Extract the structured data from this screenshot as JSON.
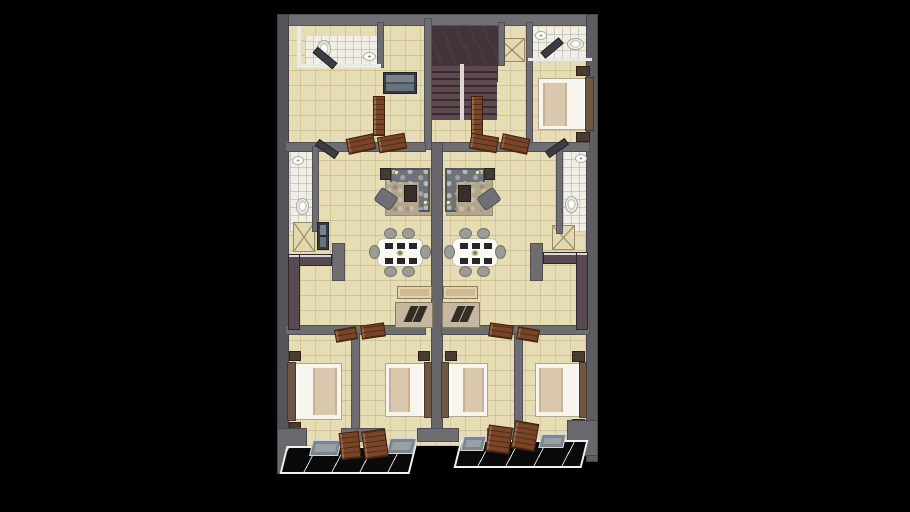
{
  "scene": {
    "description": "3D rendered duplex apartment floor plan, two mirrored units, viewed from above on black background",
    "background": "#000000",
    "plan": {
      "left": 277,
      "top": 14,
      "width": 321,
      "height": 466
    }
  },
  "palette": {
    "wall_gray": "#6e6e71",
    "wall_dark": "#56565c",
    "wall_white": "#e9e9e5",
    "floor_beige": "#e7ddb4",
    "bath_tile": "#f1eee6",
    "stair_dark": "#43333a",
    "door_wood": "#7a4526",
    "counter_dark": "#574a50",
    "porch_black": "#0a0a0a",
    "rug_taupe": "#b4a58d",
    "sofa_gray": "#6e7277",
    "bed_white": "#f7f5ee",
    "blanket_tan": "#d9c7ae",
    "console_wood": "#cfba93"
  },
  "elements": [
    {
      "n": "interior-floor",
      "t": "floor",
      "x": 8,
      "y": 8,
      "w": 305,
      "h": 424
    },
    {
      "n": "bathroom-top-left-floor",
      "t": "floor-bath",
      "x": 28,
      "y": 22,
      "w": 74,
      "h": 30
    },
    {
      "n": "bathroom-top-right-floor",
      "t": "floor-bath",
      "x": 253,
      "y": 13,
      "w": 62,
      "h": 32
    },
    {
      "n": "bathroom-mid-left-floor",
      "t": "floor-bath",
      "x": 13,
      "y": 138,
      "w": 22,
      "h": 80
    },
    {
      "n": "bathroom-mid-right-floor",
      "t": "floor-bath",
      "x": 286,
      "y": 136,
      "w": 24,
      "h": 82
    },
    {
      "n": "stair-ceiling-slab",
      "t": "stair-slab",
      "x": 151,
      "y": 12,
      "w": 70,
      "h": 40
    },
    {
      "n": "stair-ceiling-slab-lower",
      "t": "stair-slab",
      "x": 187,
      "y": 30,
      "w": 34,
      "h": 38
    },
    {
      "n": "stair-treads",
      "t": "stair-treads",
      "x": 153,
      "y": 52,
      "w": 67,
      "h": 54
    },
    {
      "n": "stair-stringer",
      "t": "stair-stringer",
      "x": 183,
      "y": 50,
      "w": 4,
      "h": 58
    },
    {
      "n": "shaft-x-top",
      "t": "closet-x",
      "x": 222,
      "y": 24,
      "w": 26,
      "h": 24
    },
    {
      "n": "shaft-x-mid-left",
      "t": "closet-x",
      "x": 16,
      "y": 208,
      "w": 22,
      "h": 30
    },
    {
      "n": "shaft-x-mid-right",
      "t": "closet-x",
      "x": 275,
      "y": 211,
      "w": 23,
      "h": 25
    },
    {
      "n": "rug-left-unit",
      "t": "rug",
      "x": 108,
      "y": 154,
      "w": 47,
      "h": 48
    },
    {
      "n": "rug-right-unit",
      "t": "rug",
      "x": 169,
      "y": 154,
      "w": 47,
      "h": 48
    },
    {
      "n": "wall-top",
      "t": "wall",
      "x": 0,
      "y": 0,
      "w": 321,
      "h": 12,
      "f": "#707074"
    },
    {
      "n": "wall-left",
      "t": "wall",
      "x": 0,
      "y": 0,
      "w": 12,
      "h": 452,
      "f": "#55555b"
    },
    {
      "n": "wall-right",
      "t": "wall",
      "x": 309,
      "y": 0,
      "w": 12,
      "h": 448,
      "f": "#5d5d62"
    },
    {
      "n": "wall-stair-left",
      "t": "wall",
      "x": 147,
      "y": 4,
      "w": 8,
      "h": 132
    },
    {
      "n": "wall-stair-right",
      "t": "wall",
      "x": 221,
      "y": 8,
      "w": 7,
      "h": 44
    },
    {
      "n": "wall-bath-top-left-east",
      "t": "wall",
      "x": 100,
      "y": 8,
      "w": 7,
      "h": 46
    },
    {
      "n": "wall-bedroom-top-right-west",
      "t": "wall",
      "x": 249,
      "y": 8,
      "w": 7,
      "h": 122
    },
    {
      "n": "wall-mid-horizontal-left",
      "t": "wall",
      "x": 8,
      "y": 128,
      "w": 141,
      "h": 10
    },
    {
      "n": "wall-mid-horizontal-right",
      "t": "wall",
      "x": 164,
      "y": 128,
      "w": 149,
      "h": 10
    },
    {
      "n": "wall-center-party",
      "t": "wall",
      "x": 154,
      "y": 128,
      "w": 12,
      "h": 294,
      "f": "#67676b"
    },
    {
      "n": "wall-bath-mid-left-east",
      "t": "wall",
      "x": 35,
      "y": 132,
      "w": 7,
      "h": 86
    },
    {
      "n": "wall-bath-mid-right-west",
      "t": "wall",
      "x": 279,
      "y": 130,
      "w": 7,
      "h": 90
    },
    {
      "n": "wall-kitchen-stub-left",
      "t": "wall",
      "x": 55,
      "y": 229,
      "w": 13,
      "h": 38
    },
    {
      "n": "wall-kitchen-stub-right",
      "t": "wall",
      "x": 253,
      "y": 229,
      "w": 13,
      "h": 38
    },
    {
      "n": "wall-bedroom-band-left",
      "t": "wall",
      "x": 8,
      "y": 311,
      "w": 141,
      "h": 10
    },
    {
      "n": "wall-bedroom-band-right",
      "t": "wall",
      "x": 164,
      "y": 311,
      "w": 149,
      "h": 10
    },
    {
      "n": "wall-bedroom-sep-ab",
      "t": "wall",
      "x": 74,
      "y": 319,
      "w": 9,
      "h": 103
    },
    {
      "n": "wall-bedroom-sep-cd",
      "t": "wall",
      "x": 237,
      "y": 319,
      "w": 9,
      "h": 103
    },
    {
      "n": "wall-bottom-seg-1",
      "t": "wall",
      "x": 8,
      "y": 414,
      "w": 22,
      "h": 14
    },
    {
      "n": "wall-bottom-seg-2",
      "t": "wall",
      "x": 64,
      "y": 414,
      "w": 44,
      "h": 14
    },
    {
      "n": "wall-bottom-seg-3",
      "t": "wall",
      "x": 140,
      "y": 414,
      "w": 42,
      "h": 14
    },
    {
      "n": "wall-bottom-seg-4",
      "t": "wall",
      "x": 210,
      "y": 414,
      "w": 48,
      "h": 14
    },
    {
      "n": "wall-bottom-seg-5",
      "t": "wall",
      "x": 290,
      "y": 414,
      "w": 23,
      "h": 14
    },
    {
      "n": "wall-cap-white-top-left",
      "t": "wall-white",
      "x": 20,
      "y": 12,
      "w": 4,
      "h": 42
    },
    {
      "n": "wall-cap-white-bath-tl",
      "t": "wall-white",
      "x": 24,
      "y": 50,
      "w": 80,
      "h": 4
    },
    {
      "n": "wall-cap-white-bath-tr",
      "t": "wall-white",
      "x": 251,
      "y": 44,
      "w": 64,
      "h": 3
    },
    {
      "n": "kitchen-counter-left-top",
      "t": "counter",
      "x": 11,
      "y": 240,
      "w": 44,
      "h": 12
    },
    {
      "n": "kitchen-counter-left-side",
      "t": "counter",
      "x": 11,
      "y": 240,
      "w": 12,
      "h": 76
    },
    {
      "n": "kitchen-counter-right-top",
      "t": "counter",
      "x": 266,
      "y": 238,
      "w": 45,
      "h": 12
    },
    {
      "n": "kitchen-counter-right-side",
      "t": "counter",
      "x": 299,
      "y": 238,
      "w": 12,
      "h": 78
    },
    {
      "n": "fridge-cabinet-left",
      "t": "cabinet",
      "x": 40,
      "y": 208,
      "w": 12,
      "h": 28
    },
    {
      "n": "hall-cabinet-stair",
      "t": "cabinet",
      "x": 106,
      "y": 58,
      "w": 34,
      "h": 22
    },
    {
      "n": "sofa-sectional-left",
      "t": "sofa-l",
      "x": 113,
      "y": 154,
      "w": 40,
      "h": 44,
      "c": "polygon(0% 0%,100% 0%,100% 100%,72% 100%,72% 32%,0% 32%)"
    },
    {
      "n": "sofa-sectional-right",
      "t": "sofa-l",
      "x": 168,
      "y": 154,
      "w": 40,
      "h": 44,
      "c": "polygon(0% 0%,100% 0%,100% 32%,28% 32%,28% 100%,0% 100%)"
    },
    {
      "n": "side-table-left",
      "t": "side-table",
      "x": 103,
      "y": 154,
      "w": 11,
      "h": 12
    },
    {
      "n": "side-table-right",
      "t": "side-table",
      "x": 207,
      "y": 154,
      "w": 11,
      "h": 12
    },
    {
      "n": "coffee-table-left",
      "t": "coffee-table",
      "x": 127,
      "y": 171,
      "w": 13,
      "h": 17
    },
    {
      "n": "coffee-table-right",
      "t": "coffee-table",
      "x": 181,
      "y": 171,
      "w": 13,
      "h": 17
    },
    {
      "n": "armchair-left",
      "t": "armchair",
      "x": 99,
      "y": 177,
      "w": 20,
      "h": 16,
      "r": 35
    },
    {
      "n": "armchair-right",
      "t": "armchair",
      "x": 202,
      "y": 177,
      "w": 20,
      "h": 16,
      "r": -35
    },
    {
      "n": "plant-left-1",
      "t": "plant",
      "x": 117,
      "y": 156,
      "w": 6,
      "h": 6
    },
    {
      "n": "plant-left-2",
      "t": "plant",
      "x": 146,
      "y": 186,
      "w": 6,
      "h": 6
    },
    {
      "n": "plant-right-1",
      "t": "plant",
      "x": 198,
      "y": 156,
      "w": 6,
      "h": 6
    },
    {
      "n": "plant-right-2",
      "t": "plant",
      "x": 169,
      "y": 186,
      "w": 6,
      "h": 6
    },
    {
      "n": "dining-table-left",
      "t": "dining-table",
      "x": 100,
      "y": 224,
      "w": 46,
      "h": 29
    },
    {
      "n": "dining-chair",
      "t": "chair",
      "x": 107,
      "y": 214,
      "w": 13,
      "h": 11
    },
    {
      "n": "dining-chair",
      "t": "chair",
      "x": 125,
      "y": 214,
      "w": 13,
      "h": 11
    },
    {
      "n": "dining-chair",
      "t": "chair",
      "x": 107,
      "y": 252,
      "w": 13,
      "h": 11
    },
    {
      "n": "dining-chair",
      "t": "chair",
      "x": 125,
      "y": 252,
      "w": 13,
      "h": 11
    },
    {
      "n": "dining-chair",
      "t": "chair",
      "x": 92,
      "y": 231,
      "w": 11,
      "h": 14
    },
    {
      "n": "dining-chair",
      "t": "chair",
      "x": 143,
      "y": 231,
      "w": 11,
      "h": 14
    },
    {
      "n": "dining-table-right",
      "t": "dining-table",
      "x": 175,
      "y": 224,
      "w": 46,
      "h": 29
    },
    {
      "n": "dining-chair",
      "t": "chair",
      "x": 182,
      "y": 214,
      "w": 13,
      "h": 11
    },
    {
      "n": "dining-chair",
      "t": "chair",
      "x": 200,
      "y": 214,
      "w": 13,
      "h": 11
    },
    {
      "n": "dining-chair",
      "t": "chair",
      "x": 182,
      "y": 252,
      "w": 13,
      "h": 11
    },
    {
      "n": "dining-chair",
      "t": "chair",
      "x": 200,
      "y": 252,
      "w": 13,
      "h": 11
    },
    {
      "n": "dining-chair",
      "t": "chair",
      "x": 167,
      "y": 231,
      "w": 11,
      "h": 14
    },
    {
      "n": "dining-chair",
      "t": "chair",
      "x": 218,
      "y": 231,
      "w": 11,
      "h": 14
    },
    {
      "n": "tv-console-left",
      "t": "console",
      "x": 120,
      "y": 272,
      "w": 35,
      "h": 13
    },
    {
      "n": "tv-console-right",
      "t": "console",
      "x": 166,
      "y": 272,
      "w": 35,
      "h": 13
    },
    {
      "n": "sofa-low-left",
      "t": "sofa-low",
      "x": 118,
      "y": 288,
      "w": 38,
      "h": 26
    },
    {
      "n": "sofa-low-right",
      "t": "sofa-low",
      "x": 165,
      "y": 288,
      "w": 38,
      "h": 26
    },
    {
      "n": "bed-top-right",
      "t": "bed",
      "v": "head-right",
      "x": 261,
      "y": 64,
      "w": 54,
      "h": 52
    },
    {
      "n": "nightstand",
      "t": "nightstand",
      "x": 299,
      "y": 52,
      "w": 14,
      "h": 10
    },
    {
      "n": "nightstand",
      "t": "nightstand",
      "x": 299,
      "y": 118,
      "w": 14,
      "h": 10
    },
    {
      "n": "bed-bottom-a",
      "t": "bed",
      "v": "head-left",
      "x": 12,
      "y": 349,
      "w": 53,
      "h": 57
    },
    {
      "n": "nightstand",
      "t": "nightstand",
      "x": 12,
      "y": 337,
      "w": 12,
      "h": 10
    },
    {
      "n": "nightstand",
      "t": "nightstand",
      "x": 12,
      "y": 408,
      "w": 12,
      "h": 10
    },
    {
      "n": "bed-bottom-b",
      "t": "bed",
      "v": "head-right",
      "x": 108,
      "y": 349,
      "w": 45,
      "h": 54
    },
    {
      "n": "nightstand",
      "t": "nightstand",
      "x": 141,
      "y": 337,
      "w": 12,
      "h": 10
    },
    {
      "n": "bed-bottom-c",
      "t": "bed",
      "v": "head-left",
      "x": 166,
      "y": 349,
      "w": 45,
      "h": 54
    },
    {
      "n": "nightstand",
      "t": "nightstand",
      "x": 168,
      "y": 337,
      "w": 12,
      "h": 10
    },
    {
      "n": "bed-bottom-d",
      "t": "bed",
      "v": "head-right",
      "x": 258,
      "y": 349,
      "w": 50,
      "h": 54
    },
    {
      "n": "nightstand",
      "t": "nightstand",
      "x": 295,
      "y": 337,
      "w": 13,
      "h": 11
    },
    {
      "n": "nightstand",
      "t": "nightstand",
      "x": 295,
      "y": 405,
      "w": 13,
      "h": 11
    },
    {
      "n": "toilet",
      "t": "toilet",
      "x": 40,
      "y": 26,
      "w": 14,
      "h": 18
    },
    {
      "n": "sink",
      "t": "sink",
      "x": 86,
      "y": 38,
      "w": 13,
      "h": 9
    },
    {
      "n": "toilet",
      "t": "toilet",
      "x": 290,
      "y": 24,
      "w": 17,
      "h": 12
    },
    {
      "n": "sink",
      "t": "sink",
      "x": 258,
      "y": 17,
      "w": 12,
      "h": 9
    },
    {
      "n": "toilet",
      "t": "toilet",
      "x": 19,
      "y": 184,
      "w": 13,
      "h": 17
    },
    {
      "n": "sink",
      "t": "sink",
      "x": 15,
      "y": 142,
      "w": 12,
      "h": 9
    },
    {
      "n": "toilet",
      "t": "toilet",
      "x": 288,
      "y": 182,
      "w": 13,
      "h": 17
    },
    {
      "n": "sink",
      "t": "sink",
      "x": 298,
      "y": 140,
      "w": 12,
      "h": 9
    },
    {
      "n": "door-leaf-bath-tl",
      "t": "door-dark",
      "x": 35,
      "y": 40,
      "w": 26,
      "h": 8,
      "r": 40
    },
    {
      "n": "door-leaf-bath-tr",
      "t": "door-dark",
      "x": 263,
      "y": 30,
      "w": 24,
      "h": 8,
      "r": -40
    },
    {
      "n": "door-leaf-bath-ml",
      "t": "door-dark",
      "x": 38,
      "y": 131,
      "w": 24,
      "h": 8,
      "r": 35
    },
    {
      "n": "door-leaf-bath-mr",
      "t": "door-dark",
      "x": 268,
      "y": 130,
      "w": 24,
      "h": 8,
      "r": -35
    },
    {
      "n": "door-leaf-bedroom-top-left",
      "t": "door-wood",
      "x": 96,
      "y": 82,
      "w": 12,
      "h": 40
    },
    {
      "n": "door-leaf-bedroom-top-right",
      "t": "door-wood",
      "x": 194,
      "y": 82,
      "w": 12,
      "h": 40
    },
    {
      "n": "door-leaf-hall-1",
      "t": "door-wood",
      "x": 70,
      "y": 122,
      "w": 28,
      "h": 16,
      "r": -12
    },
    {
      "n": "door-leaf-hall-2",
      "t": "door-wood",
      "x": 101,
      "y": 121,
      "w": 28,
      "h": 16,
      "r": -10
    },
    {
      "n": "door-leaf-hall-3",
      "t": "door-wood",
      "x": 193,
      "y": 121,
      "w": 28,
      "h": 16,
      "r": 10
    },
    {
      "n": "door-leaf-hall-4",
      "t": "door-wood",
      "x": 224,
      "y": 122,
      "w": 28,
      "h": 16,
      "r": 12
    },
    {
      "n": "door-leaf-bedroom-a",
      "t": "door-wood",
      "x": 58,
      "y": 314,
      "w": 22,
      "h": 13,
      "r": -10
    },
    {
      "n": "door-leaf-bedroom-b",
      "t": "door-wood",
      "x": 84,
      "y": 310,
      "w": 24,
      "h": 14,
      "r": -8
    },
    {
      "n": "door-leaf-bedroom-c",
      "t": "door-wood",
      "x": 212,
      "y": 310,
      "w": 24,
      "h": 14,
      "r": 8
    },
    {
      "n": "door-leaf-bedroom-d",
      "t": "door-wood",
      "x": 240,
      "y": 314,
      "w": 22,
      "h": 13,
      "r": 10
    },
    {
      "n": "terrace-slab-left",
      "t": "slab",
      "x": 0,
      "y": 414,
      "w": 30,
      "h": 46
    },
    {
      "n": "terrace-slab-right",
      "t": "slab",
      "x": 290,
      "y": 406,
      "w": 31,
      "h": 36
    },
    {
      "n": "entry-porch-left",
      "t": "porch",
      "x": 6,
      "y": 432,
      "w": 130,
      "h": 28
    },
    {
      "n": "entry-porch-right",
      "t": "porch",
      "x": 180,
      "y": 426,
      "w": 128,
      "h": 28
    },
    {
      "n": "entry-mat",
      "t": "mat",
      "x": 34,
      "y": 426,
      "w": 29,
      "h": 16
    },
    {
      "n": "entry-mat",
      "t": "mat",
      "x": 111,
      "y": 424,
      "w": 27,
      "h": 16
    },
    {
      "n": "entry-mat",
      "t": "mat",
      "x": 185,
      "y": 422,
      "w": 23,
      "h": 15
    },
    {
      "n": "entry-mat",
      "t": "mat",
      "x": 263,
      "y": 420,
      "w": 25,
      "h": 14
    },
    {
      "n": "entry-door-left-1",
      "t": "door-wood",
      "x": 63,
      "y": 418,
      "w": 20,
      "h": 27,
      "r": -6
    },
    {
      "n": "entry-door-left-2",
      "t": "door-wood",
      "x": 86,
      "y": 416,
      "w": 24,
      "h": 28,
      "r": -8
    },
    {
      "n": "entry-door-right-1",
      "t": "door-wood",
      "x": 210,
      "y": 412,
      "w": 24,
      "h": 27,
      "r": 8
    },
    {
      "n": "entry-door-right-2",
      "t": "door-wood",
      "x": 236,
      "y": 408,
      "w": 24,
      "h": 28,
      "r": 10
    }
  ]
}
